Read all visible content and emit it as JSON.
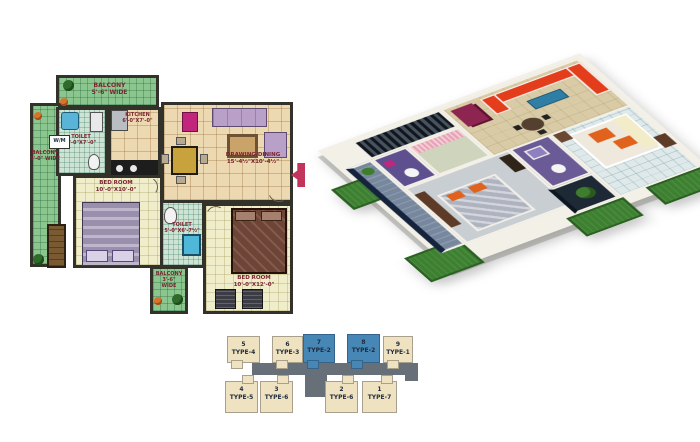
{
  "plan2d": {
    "balcony_top": {
      "name": "BALCONY",
      "dim": "5'-6\" WIDE"
    },
    "balcony_left": {
      "name": "BALCONY",
      "dim": "5'-0\" WIDE"
    },
    "wm_label": "W/M",
    "toilet1": {
      "name": "TOILET",
      "dim": "4'-0\"X7'-0\""
    },
    "kitchen": {
      "name": "KITCHEN",
      "dim": "6'-0\"X7'-0\""
    },
    "drawing_dining": {
      "name": "DRAWING/DINING",
      "dim": "15'-4½\"X10'-4½\""
    },
    "bedroom1": {
      "name": "BED ROOM",
      "dim": "10'-0\"X10'-0\""
    },
    "toilet2": {
      "name": "TOILET",
      "dim": "5'-0\"X6'-7½\""
    },
    "balcony_bottom": {
      "name": "BALCONY",
      "dim": "3'-6\"",
      "width_word": "WIDE"
    },
    "bedroom2": {
      "name": "BED ROOM",
      "dim": "10'-0\"X12'-0\""
    },
    "entry_label": "ENTRY"
  },
  "keyplan": {
    "units_top": [
      {
        "number": "5",
        "type": "TYPE-4",
        "highlighted": false
      },
      {
        "number": "6",
        "type": "TYPE-3",
        "highlighted": false
      },
      {
        "number": "7",
        "type": "TYPE-2",
        "highlighted": true
      },
      {
        "number": "8",
        "type": "TYPE-2",
        "highlighted": true
      },
      {
        "number": "9",
        "type": "TYPE-1",
        "highlighted": false
      }
    ],
    "units_bottom": [
      {
        "number": "4",
        "type": "TYPE-5",
        "highlighted": false
      },
      {
        "number": "3",
        "type": "TYPE-6",
        "highlighted": false
      },
      {
        "number": "2",
        "type": "TYPE-6",
        "highlighted": false
      },
      {
        "number": "1",
        "type": "TYPE-7",
        "highlighted": false
      }
    ],
    "colors": {
      "highlight": "#4687b5",
      "unit_fill": "#efe2c0",
      "connector": "#677078"
    }
  },
  "colors": {
    "wall": "#32312a",
    "balcony_green": "#8cc68f",
    "floor_beige": "#ecd9b2",
    "floor_cream": "#f0edca",
    "bath_tile": "#cde4d4",
    "label_text": "#7a2430"
  }
}
